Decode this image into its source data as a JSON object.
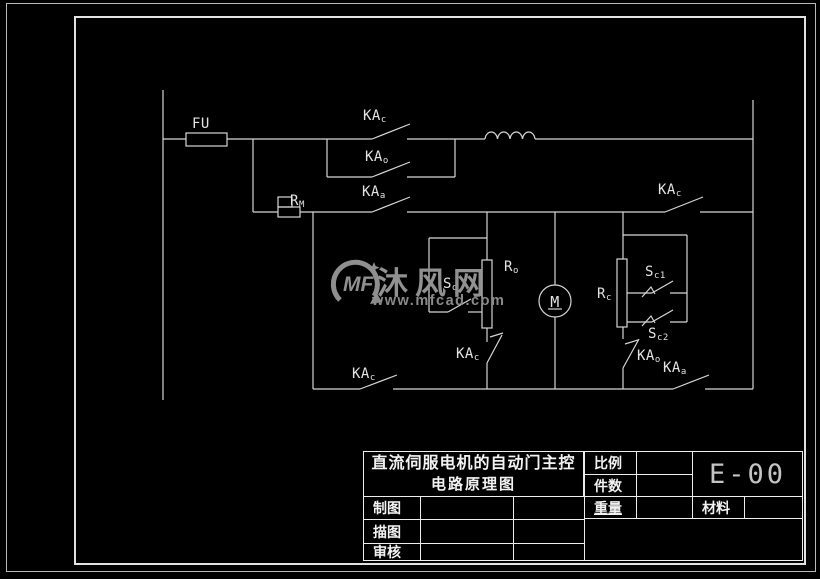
{
  "colors": {
    "background": "#000000",
    "line": "#d6d6d6",
    "label_text": "#e3e3e3",
    "titleblock_line": "#ededed",
    "watermark_gray": "#8f8f8f",
    "drawing_number_gray": "#c4c4c4"
  },
  "watermark": {
    "logo": "MF",
    "brand": "沐风网",
    "url": "www.mfcad.com"
  },
  "schematic": {
    "labels": {
      "fuse": {
        "text": "FU"
      },
      "relay_close_top": {
        "main": "KA",
        "sub": "c"
      },
      "relay_open_top": {
        "main": "KA",
        "sub": "o"
      },
      "relay_stop_top": {
        "main": "KA",
        "sub": "a"
      },
      "resistor_m": {
        "main": "R",
        "sub": "M"
      },
      "relay_close_right": {
        "main": "KA",
        "sub": "c"
      },
      "switch_open": {
        "main": "S",
        "sub": "o"
      },
      "resistor_o": {
        "main": "R",
        "sub": "o"
      },
      "motor": {
        "text": "M"
      },
      "resistor_c": {
        "main": "R",
        "sub": "c"
      },
      "switch_c1": {
        "main": "S",
        "sub": "c1"
      },
      "switch_c2": {
        "main": "S",
        "sub": "c2"
      },
      "relay_close_mid": {
        "main": "KA",
        "sub": "c"
      },
      "relay_open_low": {
        "main": "KA",
        "sub": "o"
      },
      "relay_close_bottom": {
        "main": "KA",
        "sub": "c"
      },
      "relay_stop_bottom": {
        "main": "KA",
        "sub": "a"
      }
    }
  },
  "title_block": {
    "title_line1": "直流伺服电机的自动门主控",
    "title_line2": "电路原理图",
    "scale_label": "比例",
    "quantity_label": "件数",
    "weight_label": "重量",
    "material_label": "材料",
    "drafted_label": "制图",
    "traced_label": "描图",
    "checked_label": "审核",
    "drawing_number": "E-00"
  }
}
